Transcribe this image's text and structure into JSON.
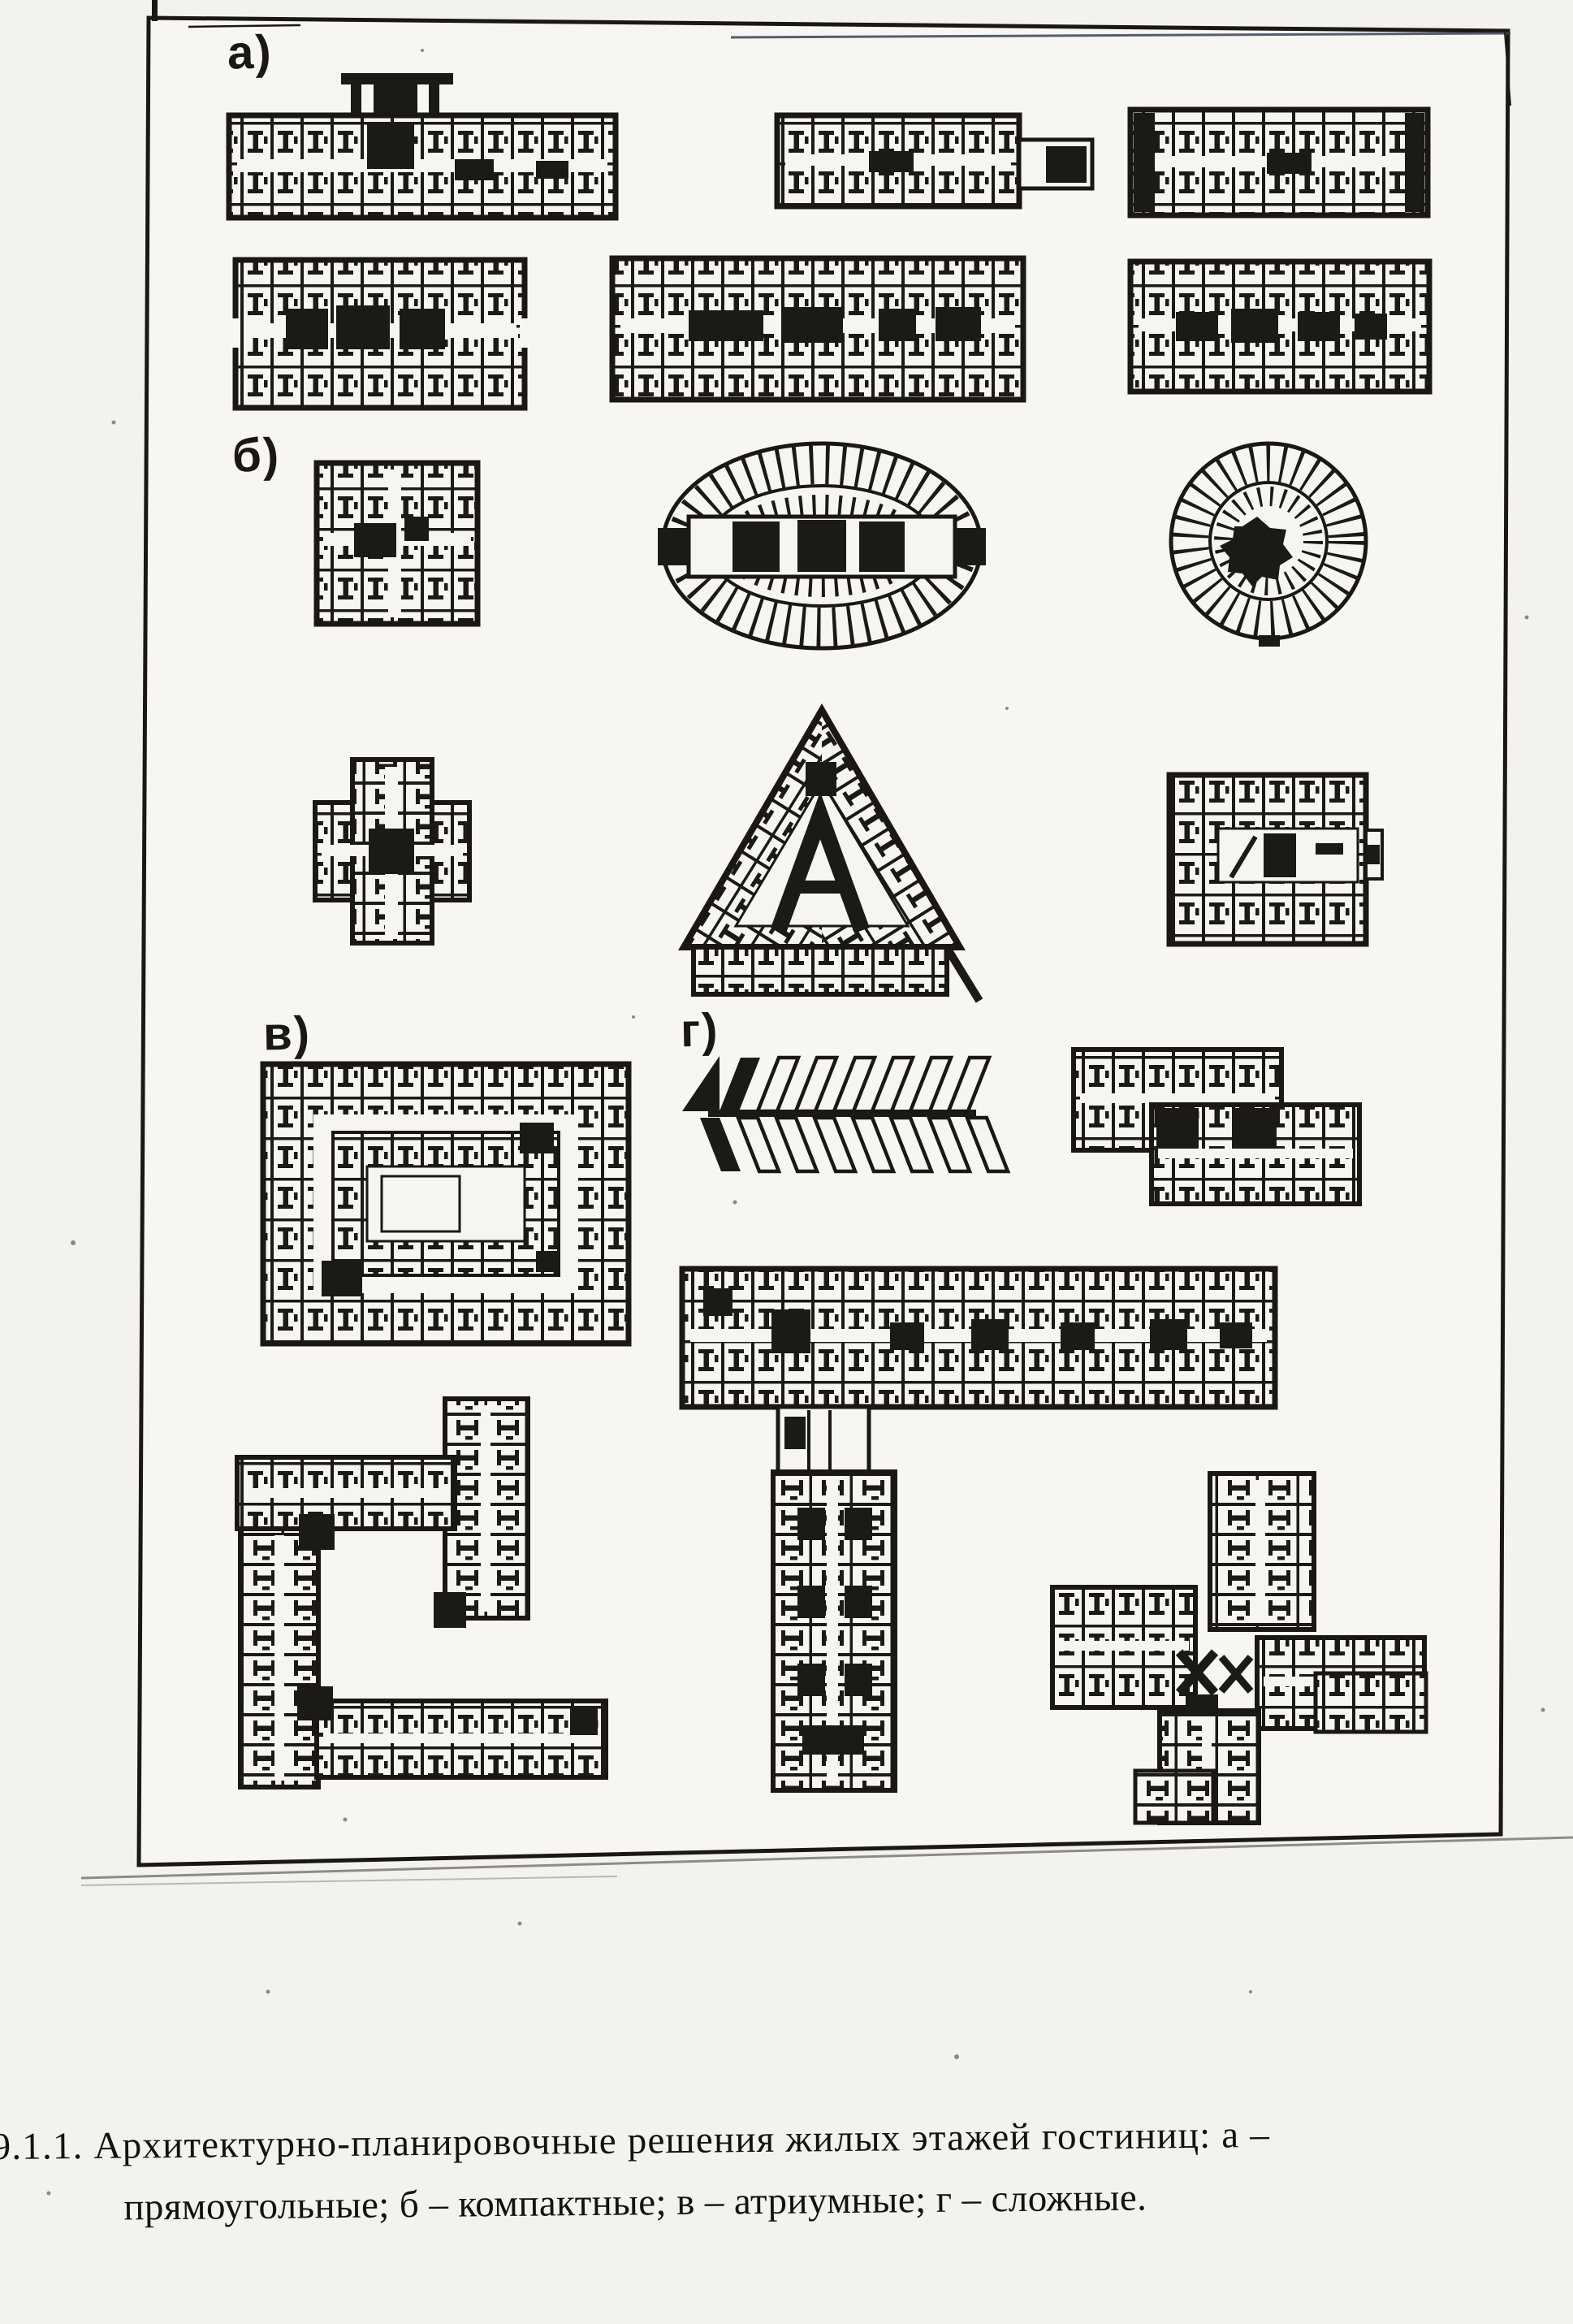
{
  "page": {
    "paper_color": "#f3f2ee",
    "ink_color": "#161411"
  },
  "figure": {
    "labels": {
      "a": "а)",
      "b": "б)",
      "v": "в)",
      "g": "г)"
    }
  },
  "caption": {
    "line1": "9.1.1. Архитектурно-планировочные решения жилых этажей гостиниц: а –",
    "line2": "прямоугольные; б – компактные; в – атриумные; г – сложные."
  }
}
